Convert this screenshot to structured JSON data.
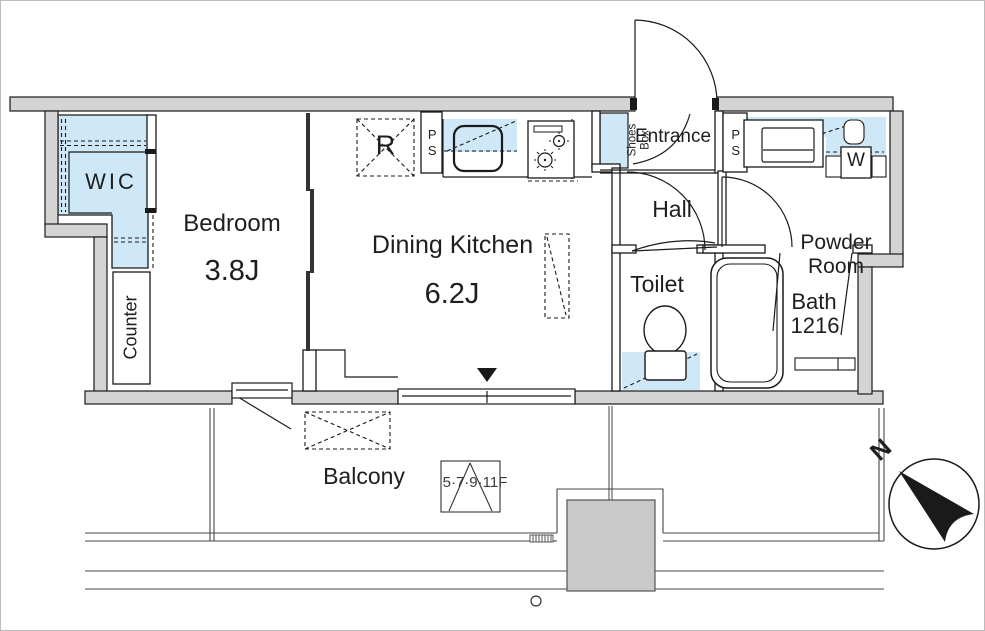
{
  "rooms": {
    "wic": {
      "label": "WIC"
    },
    "bedroom": {
      "name": "Bedroom",
      "area": "3.8J"
    },
    "counter": {
      "label": "Counter"
    },
    "dining_kitchen": {
      "name": "Dining Kitchen",
      "area": "6.2J"
    },
    "entrance": {
      "label": "Entrance"
    },
    "hall": {
      "label": "Hall"
    },
    "toilet": {
      "label": "Toilet"
    },
    "powder_room": {
      "line1": "Powder",
      "line2": "Room"
    },
    "bath": {
      "name": "Bath",
      "size": "1216"
    },
    "balcony": {
      "label": "Balcony"
    }
  },
  "fixtures": {
    "refrigerator": {
      "label": "R"
    },
    "pipe_space_kitchen": {
      "label": "PS"
    },
    "pipe_space_powder": {
      "label": "PS"
    },
    "shoes_box": {
      "line1": "Shoes",
      "line2": "Box"
    },
    "washing_machine": {
      "label": "W"
    }
  },
  "annotations": {
    "floor_access_marker": "5·7·9·11F",
    "compass_north": "N"
  },
  "colors": {
    "wall_gray": "#d4d4d4",
    "water_area_blue": "#cfe8f7",
    "line": "#1a1a1a",
    "shaft_gray": "#c9c9c9"
  }
}
